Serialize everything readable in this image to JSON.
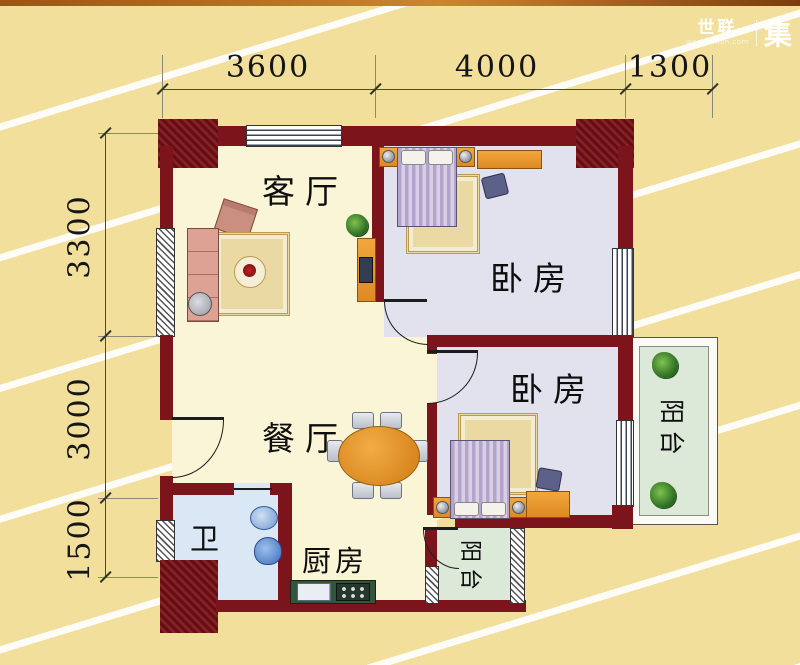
{
  "header": {
    "brand": "世联",
    "brand_sub": "worldunion.com",
    "brand_right": "集"
  },
  "dimensions": {
    "top": [
      "3600",
      "4000",
      "1300"
    ],
    "left": [
      "3300",
      "3000",
      "1500"
    ]
  },
  "rooms": {
    "living": "客厅",
    "bedroom_top": "卧房",
    "bedroom_bottom": "卧房",
    "dining": "餐厅",
    "bathroom": "卫",
    "kitchen": "厨房",
    "balcony_side": "阳台",
    "balcony_bottom": "阳台"
  },
  "colors": {
    "wall": "#7b151b",
    "floor_main": "#faf5d7",
    "floor_bedroom": "#e2e2ee",
    "floor_bathroom": "#d9e8f4",
    "floor_balcony": "#dce8d8",
    "background": "#f2df9b",
    "furniture_orange": "#e89530"
  }
}
